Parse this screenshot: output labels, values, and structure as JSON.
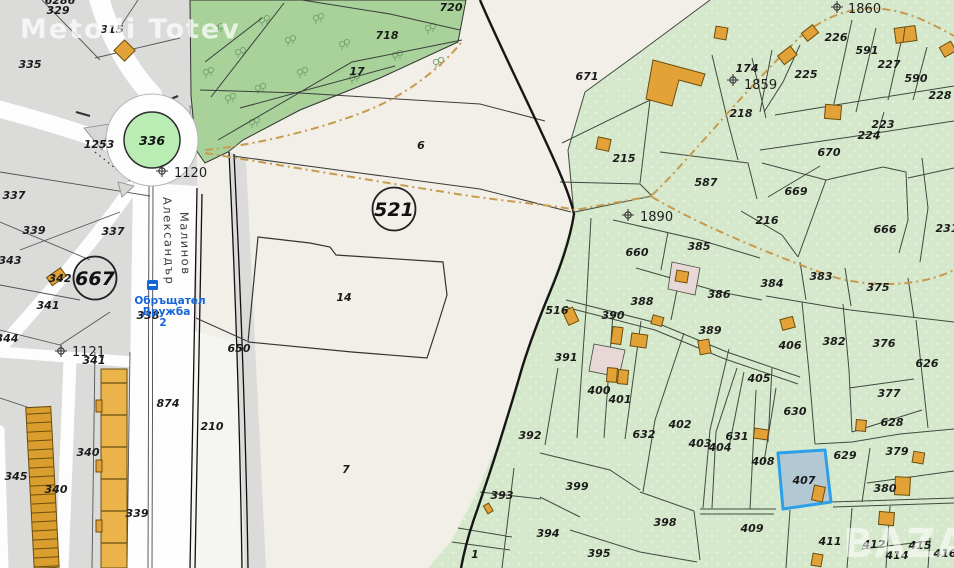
{
  "watermarks": {
    "top_left": "Metodi Totev",
    "bottom_right": "BAZAR"
  },
  "street": {
    "name_line1": "Александър",
    "name_line2": "Малинов"
  },
  "transit_stop": {
    "line1": "Обръщател",
    "line2": "Дружба",
    "line3": "2"
  },
  "roundabout": {
    "label": "336"
  },
  "zone_circles": [
    {
      "label": "667",
      "x": 95,
      "y": 278
    },
    {
      "label": "521",
      "x": 394,
      "y": 209
    }
  ],
  "selected_parcel": {
    "label": "407"
  },
  "survey_points": [
    {
      "label": "1120",
      "tx": 174,
      "ty": 177,
      "mx": 162,
      "my": 171
    },
    {
      "label": "1121",
      "tx": 72,
      "ty": 356,
      "mx": 61,
      "my": 351
    },
    {
      "label": "1890",
      "tx": 640,
      "ty": 221,
      "mx": 628,
      "my": 215
    },
    {
      "label": "1860",
      "tx": 848,
      "ty": 13,
      "mx": 837,
      "my": 7
    },
    {
      "label": "1859",
      "tx": 744,
      "ty": 89,
      "mx": 733,
      "my": 80
    }
  ],
  "parcel_labels": [
    {
      "t": "6286",
      "x": 60,
      "y": 4
    },
    {
      "t": "329",
      "x": 58,
      "y": 14
    },
    {
      "t": "335",
      "x": 30,
      "y": 68
    },
    {
      "t": "315",
      "x": 112,
      "y": 33
    },
    {
      "t": "1253",
      "x": 99,
      "y": 148
    },
    {
      "t": "337",
      "x": 14,
      "y": 199
    },
    {
      "t": "339",
      "x": 34,
      "y": 234
    },
    {
      "t": "343",
      "x": 10,
      "y": 264
    },
    {
      "t": "342",
      "x": 60,
      "y": 282
    },
    {
      "t": "341",
      "x": 48,
      "y": 309
    },
    {
      "t": "337",
      "x": 113,
      "y": 235
    },
    {
      "t": "344",
      "x": 7,
      "y": 342
    },
    {
      "t": "341",
      "x": 94,
      "y": 364
    },
    {
      "t": "338",
      "x": 148,
      "y": 319
    },
    {
      "t": "345",
      "x": 16,
      "y": 480
    },
    {
      "t": "340",
      "x": 88,
      "y": 456
    },
    {
      "t": "340",
      "x": 56,
      "y": 493
    },
    {
      "t": "339",
      "x": 137,
      "y": 517
    },
    {
      "t": "874",
      "x": 168,
      "y": 407
    },
    {
      "t": "210",
      "x": 212,
      "y": 430
    },
    {
      "t": "720",
      "x": 451,
      "y": 11
    },
    {
      "t": "718",
      "x": 387,
      "y": 39
    },
    {
      "t": "17",
      "x": 357,
      "y": 75
    },
    {
      "t": "6",
      "x": 421,
      "y": 149
    },
    {
      "t": "14",
      "x": 344,
      "y": 301
    },
    {
      "t": "650",
      "x": 239,
      "y": 352
    },
    {
      "t": "7",
      "x": 346,
      "y": 473
    },
    {
      "t": "671",
      "x": 587,
      "y": 80
    },
    {
      "t": "1",
      "x": 475,
      "y": 558
    },
    {
      "t": "215",
      "x": 624,
      "y": 162
    },
    {
      "t": "587",
      "x": 706,
      "y": 186
    },
    {
      "t": "218",
      "x": 741,
      "y": 117
    },
    {
      "t": "174",
      "x": 747,
      "y": 72
    },
    {
      "t": "225",
      "x": 806,
      "y": 78
    },
    {
      "t": "226",
      "x": 836,
      "y": 41
    },
    {
      "t": "591",
      "x": 867,
      "y": 54
    },
    {
      "t": "227",
      "x": 889,
      "y": 68
    },
    {
      "t": "590",
      "x": 916,
      "y": 82
    },
    {
      "t": "228",
      "x": 940,
      "y": 99
    },
    {
      "t": "223",
      "x": 883,
      "y": 128
    },
    {
      "t": "224",
      "x": 869,
      "y": 139
    },
    {
      "t": "670",
      "x": 829,
      "y": 156
    },
    {
      "t": "669",
      "x": 796,
      "y": 195
    },
    {
      "t": "216",
      "x": 767,
      "y": 224
    },
    {
      "t": "666",
      "x": 885,
      "y": 233
    },
    {
      "t": "231",
      "x": 947,
      "y": 232
    },
    {
      "t": "660",
      "x": 637,
      "y": 256
    },
    {
      "t": "385",
      "x": 699,
      "y": 250
    },
    {
      "t": "386",
      "x": 719,
      "y": 298
    },
    {
      "t": "388",
      "x": 642,
      "y": 305
    },
    {
      "t": "389",
      "x": 710,
      "y": 334
    },
    {
      "t": "390",
      "x": 613,
      "y": 319
    },
    {
      "t": "516",
      "x": 557,
      "y": 314
    },
    {
      "t": "391",
      "x": 566,
      "y": 361
    },
    {
      "t": "400",
      "x": 599,
      "y": 394
    },
    {
      "t": "401",
      "x": 620,
      "y": 403
    },
    {
      "t": "402",
      "x": 680,
      "y": 428
    },
    {
      "t": "632",
      "x": 644,
      "y": 438
    },
    {
      "t": "403",
      "x": 700,
      "y": 447
    },
    {
      "t": "404",
      "x": 720,
      "y": 451
    },
    {
      "t": "631",
      "x": 737,
      "y": 440
    },
    {
      "t": "405",
      "x": 759,
      "y": 382
    },
    {
      "t": "406",
      "x": 790,
      "y": 349
    },
    {
      "t": "382",
      "x": 834,
      "y": 345
    },
    {
      "t": "376",
      "x": 884,
      "y": 347
    },
    {
      "t": "626",
      "x": 927,
      "y": 367
    },
    {
      "t": "377",
      "x": 889,
      "y": 397
    },
    {
      "t": "630",
      "x": 795,
      "y": 415
    },
    {
      "t": "628",
      "x": 892,
      "y": 426
    },
    {
      "t": "375",
      "x": 878,
      "y": 291
    },
    {
      "t": "383",
      "x": 821,
      "y": 280
    },
    {
      "t": "384",
      "x": 772,
      "y": 287
    },
    {
      "t": "399",
      "x": 577,
      "y": 490
    },
    {
      "t": "394",
      "x": 548,
      "y": 537
    },
    {
      "t": "395",
      "x": 599,
      "y": 557
    },
    {
      "t": "398",
      "x": 665,
      "y": 526
    },
    {
      "t": "392",
      "x": 530,
      "y": 439
    },
    {
      "t": "393",
      "x": 502,
      "y": 499
    },
    {
      "t": "408",
      "x": 763,
      "y": 465
    },
    {
      "t": "407",
      "x": 804,
      "y": 484
    },
    {
      "t": "629",
      "x": 845,
      "y": 459
    },
    {
      "t": "379",
      "x": 897,
      "y": 455
    },
    {
      "t": "380",
      "x": 885,
      "y": 492
    },
    {
      "t": "409",
      "x": 752,
      "y": 532
    },
    {
      "t": "411",
      "x": 830,
      "y": 545
    },
    {
      "t": "412",
      "x": 874,
      "y": 548
    },
    {
      "t": "414",
      "x": 897,
      "y": 559
    },
    {
      "t": "415",
      "x": 920,
      "y": 549
    },
    {
      "t": "416",
      "x": 945,
      "y": 557
    }
  ],
  "colors": {
    "cream": "#f1efe7",
    "urban_gray": "#dbdbd9",
    "road_white": "#fdfdfd",
    "forest": "#a8d29a",
    "cadastre_green": "#d5e8cb",
    "building": "#e2a238",
    "building_stroke": "#6b4e0e",
    "selected_fill": "#a9c0d6",
    "selected_stroke": "#2ba0e8",
    "footpath": "#c79a4e",
    "transit_blue": "#1565d8",
    "roundabout_island": "#b9edb4",
    "pink_parcel": "#e7d7d6"
  }
}
